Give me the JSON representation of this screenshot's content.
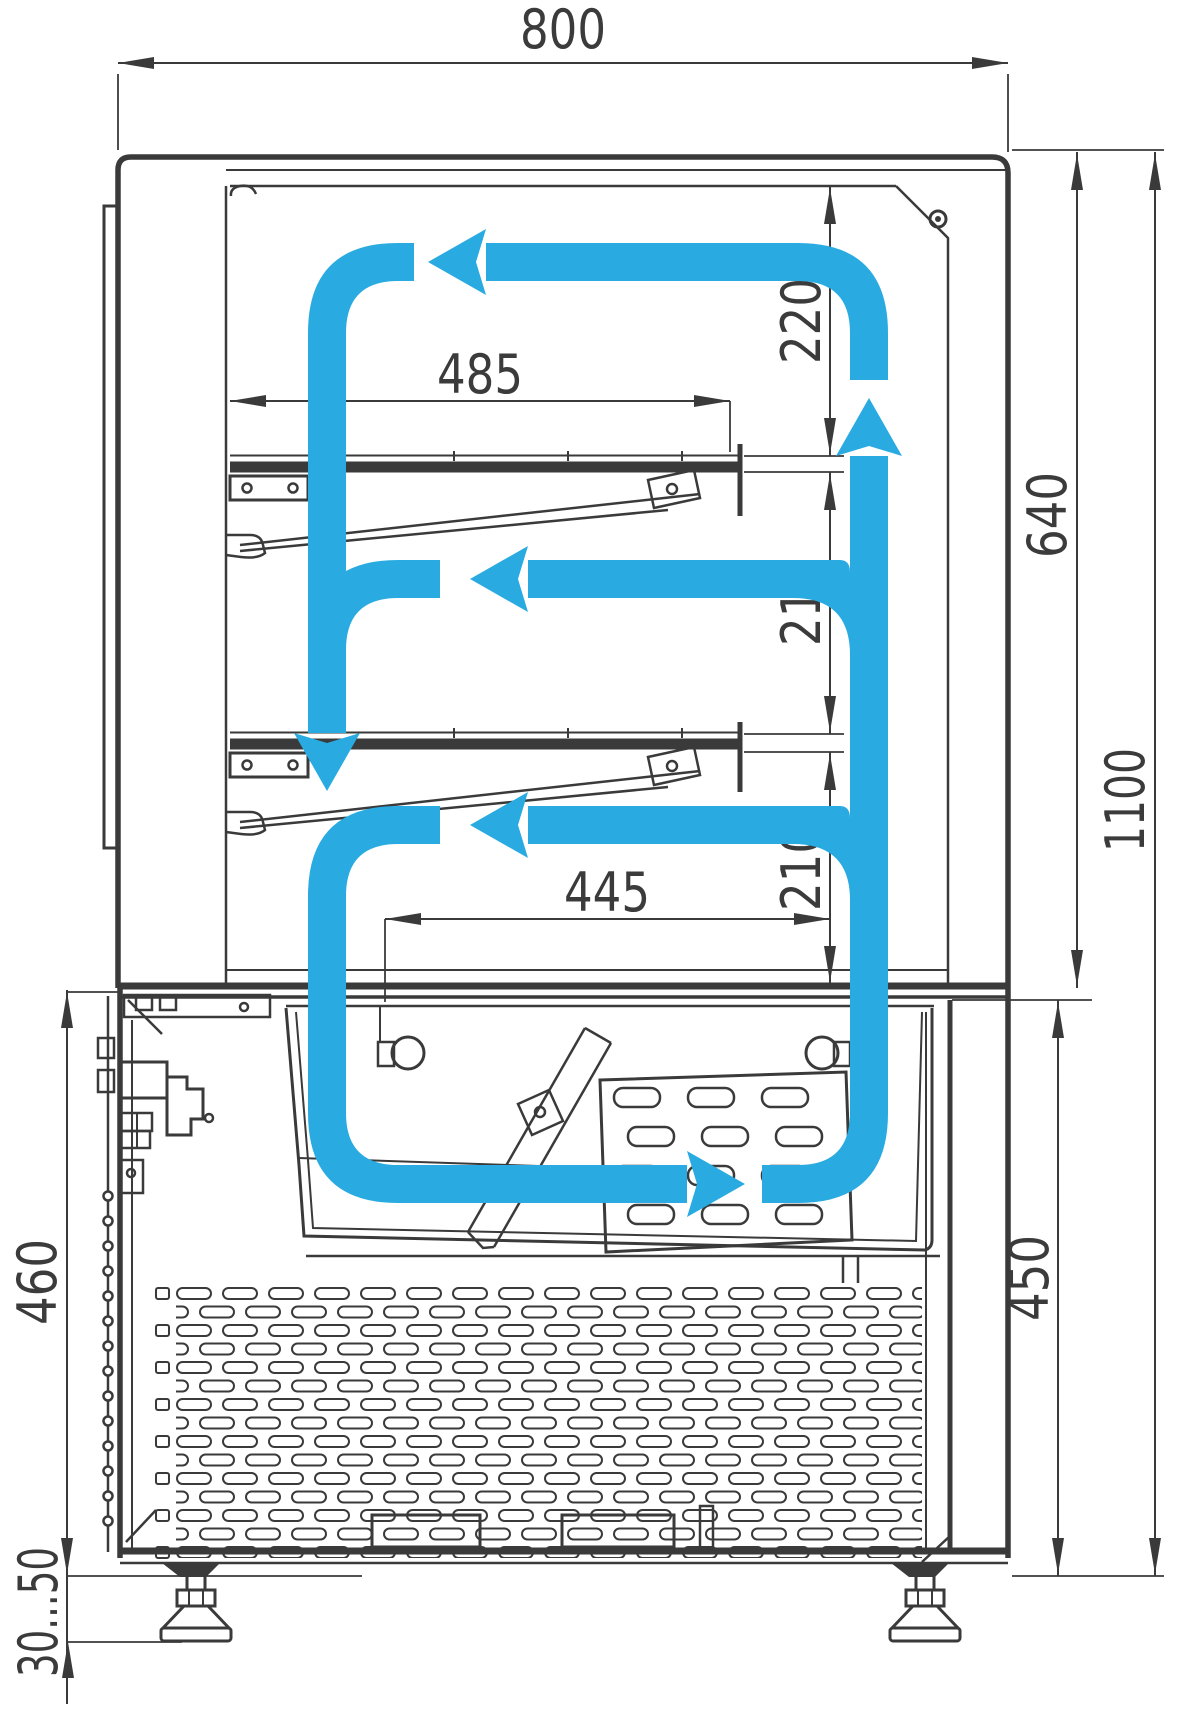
{
  "diagram": {
    "type": "technical-drawing",
    "subject": "refrigerated display case cross-section with air circulation flow",
    "colors": {
      "line": "#3A3A3A",
      "flow": "#29ABE2",
      "background": "#FFFFFF",
      "label": "#3B3B3B"
    },
    "dimensions": [
      {
        "id": "overall-width",
        "label": "800",
        "orientation": "horizontal",
        "position": "top"
      },
      {
        "id": "shelf-length",
        "label": "485",
        "orientation": "horizontal",
        "position": "upper-shelf"
      },
      {
        "id": "top-clearance",
        "label": "220",
        "orientation": "vertical",
        "position": "right-inner"
      },
      {
        "id": "shelf1-clearance",
        "label": "210",
        "orientation": "vertical",
        "position": "right-inner"
      },
      {
        "id": "shelf2-clearance",
        "label": "210",
        "orientation": "vertical",
        "position": "right-inner"
      },
      {
        "id": "display-height",
        "label": "640",
        "orientation": "vertical",
        "position": "right"
      },
      {
        "id": "tray-width",
        "label": "445",
        "orientation": "horizontal",
        "position": "middle"
      },
      {
        "id": "overall-height",
        "label": "1100",
        "orientation": "vertical",
        "position": "right-outer"
      },
      {
        "id": "base-height-left",
        "label": "460",
        "orientation": "vertical",
        "position": "left"
      },
      {
        "id": "base-height-right",
        "label": "450",
        "orientation": "vertical",
        "position": "right"
      },
      {
        "id": "foot-adjust-range",
        "label": "30...50",
        "orientation": "vertical",
        "position": "bottom-left"
      }
    ]
  }
}
